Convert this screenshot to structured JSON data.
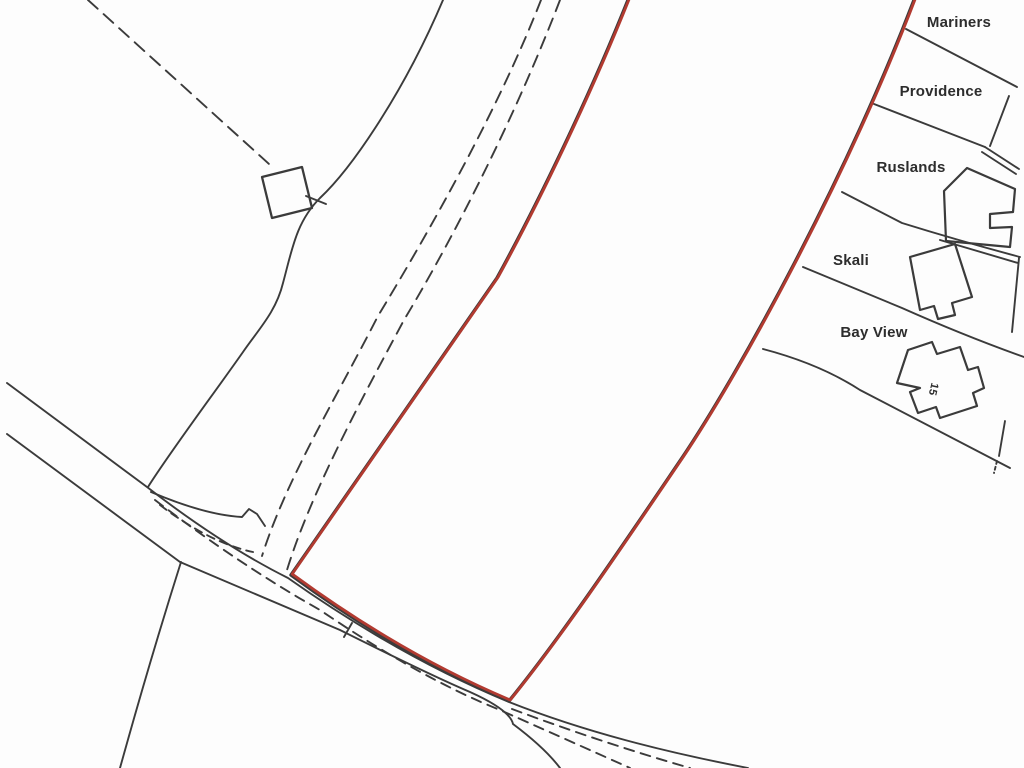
{
  "map": {
    "colors": {
      "line": "#3b3b3b",
      "boundary": "#b23a30",
      "text": "#2d2d2d",
      "background": "#fdfdfd"
    },
    "plot_labels": [
      {
        "text": "Mariners",
        "x": 959,
        "y": 27
      },
      {
        "text": "Providence",
        "x": 941,
        "y": 96
      },
      {
        "text": "Ruslands",
        "x": 911,
        "y": 172
      },
      {
        "text": "Skali",
        "x": 851,
        "y": 265
      },
      {
        "text": "Bay View",
        "x": 874,
        "y": 337
      }
    ],
    "house_number": {
      "text": "15"
    }
  }
}
